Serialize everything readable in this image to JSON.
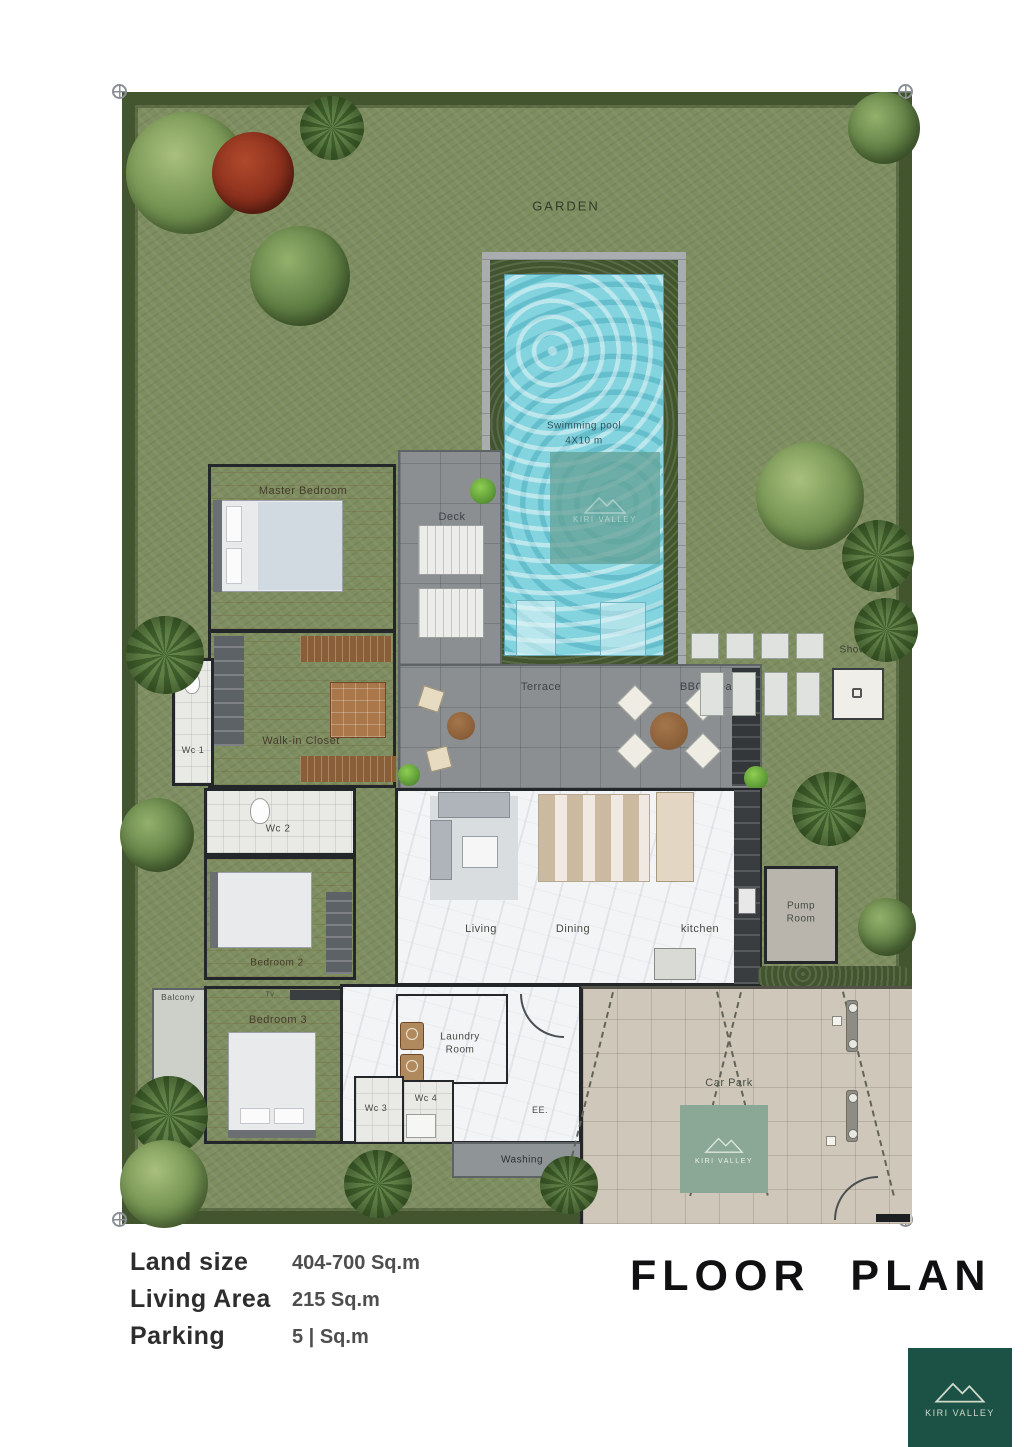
{
  "site": {
    "garden_label": "GARDEN",
    "pool": {
      "name": "Swimming pool",
      "dimensions": "4X10 m"
    },
    "areas": {
      "deck": "Deck",
      "terrace": "Terrace",
      "bbq": "BBQ area",
      "shower": "Shower",
      "master_bedroom": "Master Bedroom",
      "walk_in_closet": "Walk-in Closet",
      "wc1": "Wc 1",
      "wc2": "Wc 2",
      "bedroom2": "Bedroom 2",
      "bedroom3": "Bedroom 3",
      "balcony": "Balcony",
      "tv": "Tv",
      "living": "Living",
      "dining": "Dining",
      "kitchen": "kitchen",
      "pump_room": "Pump Room",
      "laundry_room": "Laundry Room",
      "wc3": "Wc 3",
      "wc4": "Wc 4",
      "ee": "EE.",
      "washing": "Washing",
      "car_park": "Car Park"
    },
    "watermark": "KIRI VALLEY"
  },
  "footer": {
    "specs": [
      {
        "label": "Land size",
        "value": "404-700 Sq.m"
      },
      {
        "label": "Living Area",
        "value": "215 Sq.m"
      },
      {
        "label": "Parking",
        "value": "5 | Sq.m"
      }
    ],
    "plan_title": "FLOOR PLAN",
    "logo": {
      "text": "KIRI VALLEY"
    }
  },
  "colors": {
    "grass": "#7e8e60",
    "hedge": "#42552f",
    "pool_water": "#84d4df",
    "wood_floor": "#c2905e",
    "marble": "#f3f4f6",
    "terrace_gray": "#8b8f92",
    "car_park": "#cfc8ba",
    "logo_green": "#1c5146",
    "wall": "#23272a"
  }
}
